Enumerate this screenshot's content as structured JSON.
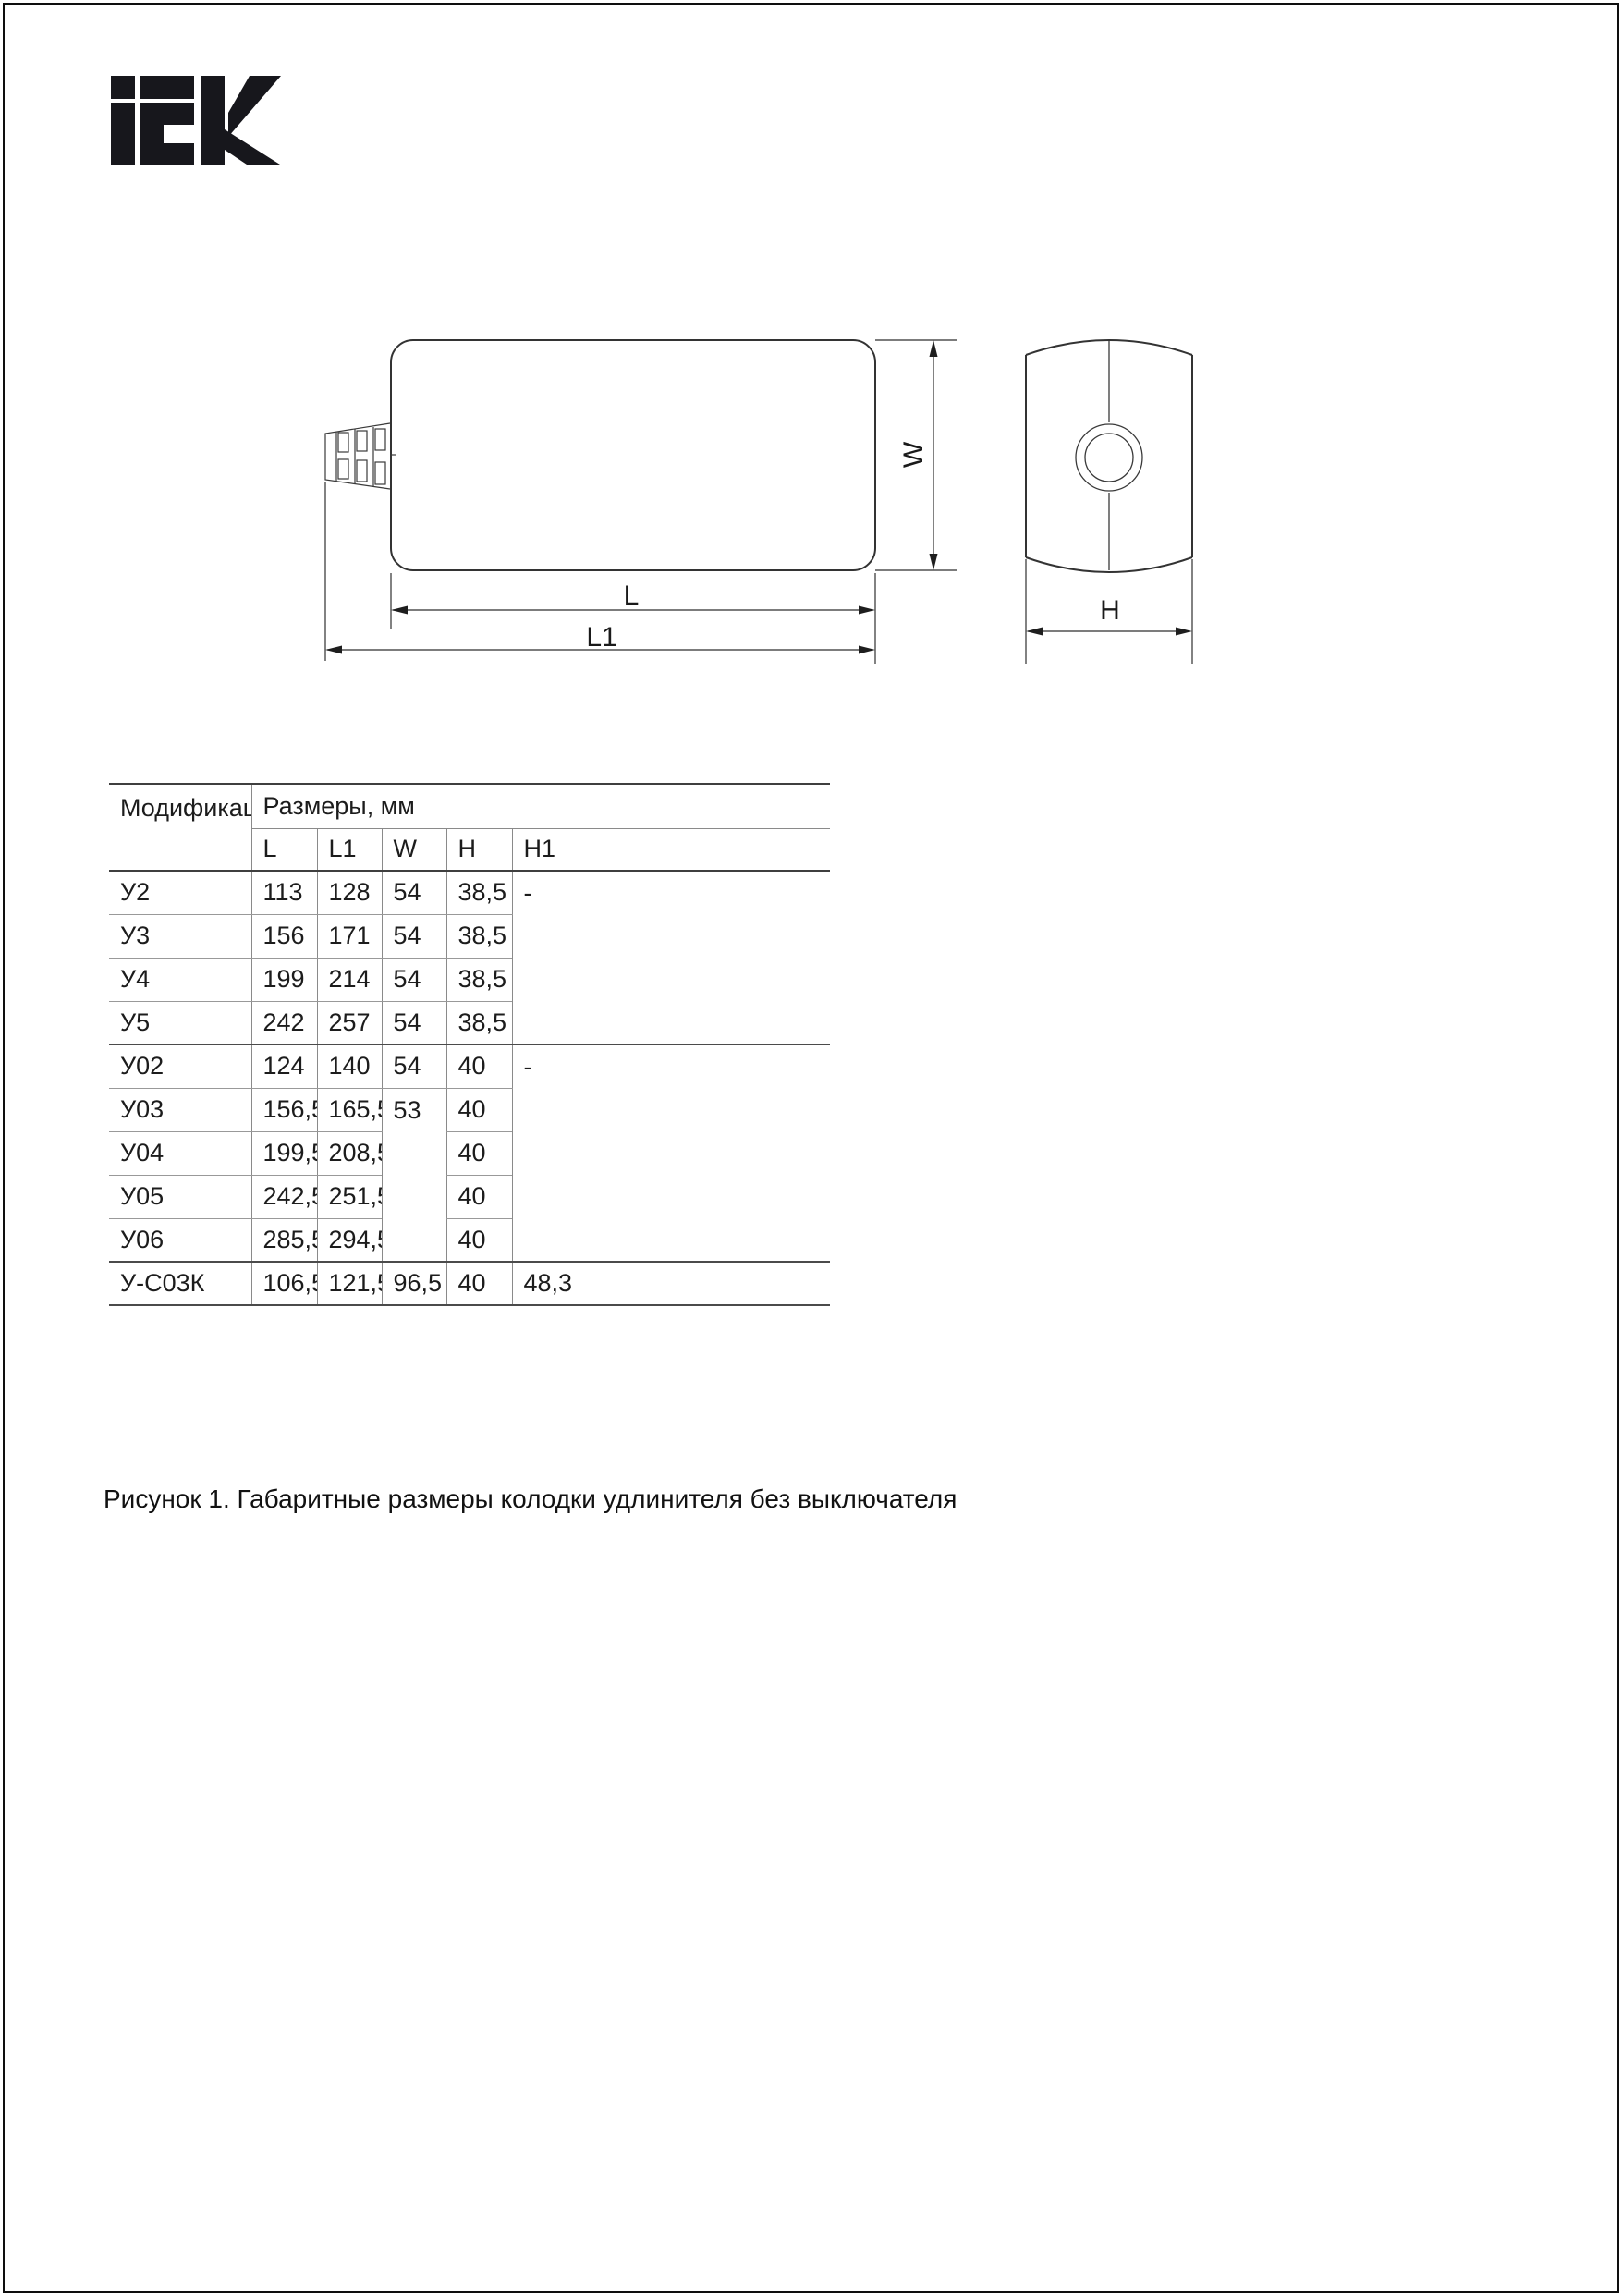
{
  "page": {
    "background": "#ffffff",
    "frame_color": "#0e0e0e"
  },
  "logo": {
    "brand": "IEK",
    "color": "#17171c"
  },
  "figure": {
    "stroke_color": "#333333",
    "labels": {
      "L": "L",
      "L1": "L1",
      "W": "W",
      "H": "H"
    }
  },
  "table": {
    "line_color_thin": "#8a8a8a",
    "line_color_thick": "#4b4b4b",
    "header": {
      "modification": "Модификация",
      "dimensions": "Размеры, мм",
      "columns": [
        "L",
        "L1",
        "W",
        "H",
        "H1"
      ]
    },
    "rows": [
      {
        "mod": "У2",
        "l": "113",
        "l1": "128",
        "w": "54",
        "h": "38,5",
        "h1": "-"
      },
      {
        "mod": "У3",
        "l": "156",
        "l1": "171",
        "w": "54",
        "h": "38,5"
      },
      {
        "mod": "У4",
        "l": "199",
        "l1": "214",
        "w": "54",
        "h": "38,5"
      },
      {
        "mod": "У5",
        "l": "242",
        "l1": "257",
        "w": "54",
        "h": "38,5"
      },
      {
        "mod": "У02",
        "l": "124",
        "l1": "140",
        "w": "54",
        "h": "40",
        "h1": "-"
      },
      {
        "mod": "У03",
        "l": "156,5",
        "l1": "165,5",
        "w": "53",
        "h": "40"
      },
      {
        "mod": "У04",
        "l": "199,5",
        "l1": "208,5",
        "h": "40"
      },
      {
        "mod": "У05",
        "l": "242,5",
        "l1": "251,5",
        "h": "40"
      },
      {
        "mod": "У06",
        "l": "285,5",
        "l1": "294,5",
        "h": "40"
      },
      {
        "mod": "У-С03К",
        "l": "106,5",
        "l1": "121,5",
        "w": "96,5",
        "h": "40",
        "h1": "48,3"
      }
    ]
  },
  "caption": "Рисунок 1. Габаритные размеры колодки удлинителя без выключателя"
}
